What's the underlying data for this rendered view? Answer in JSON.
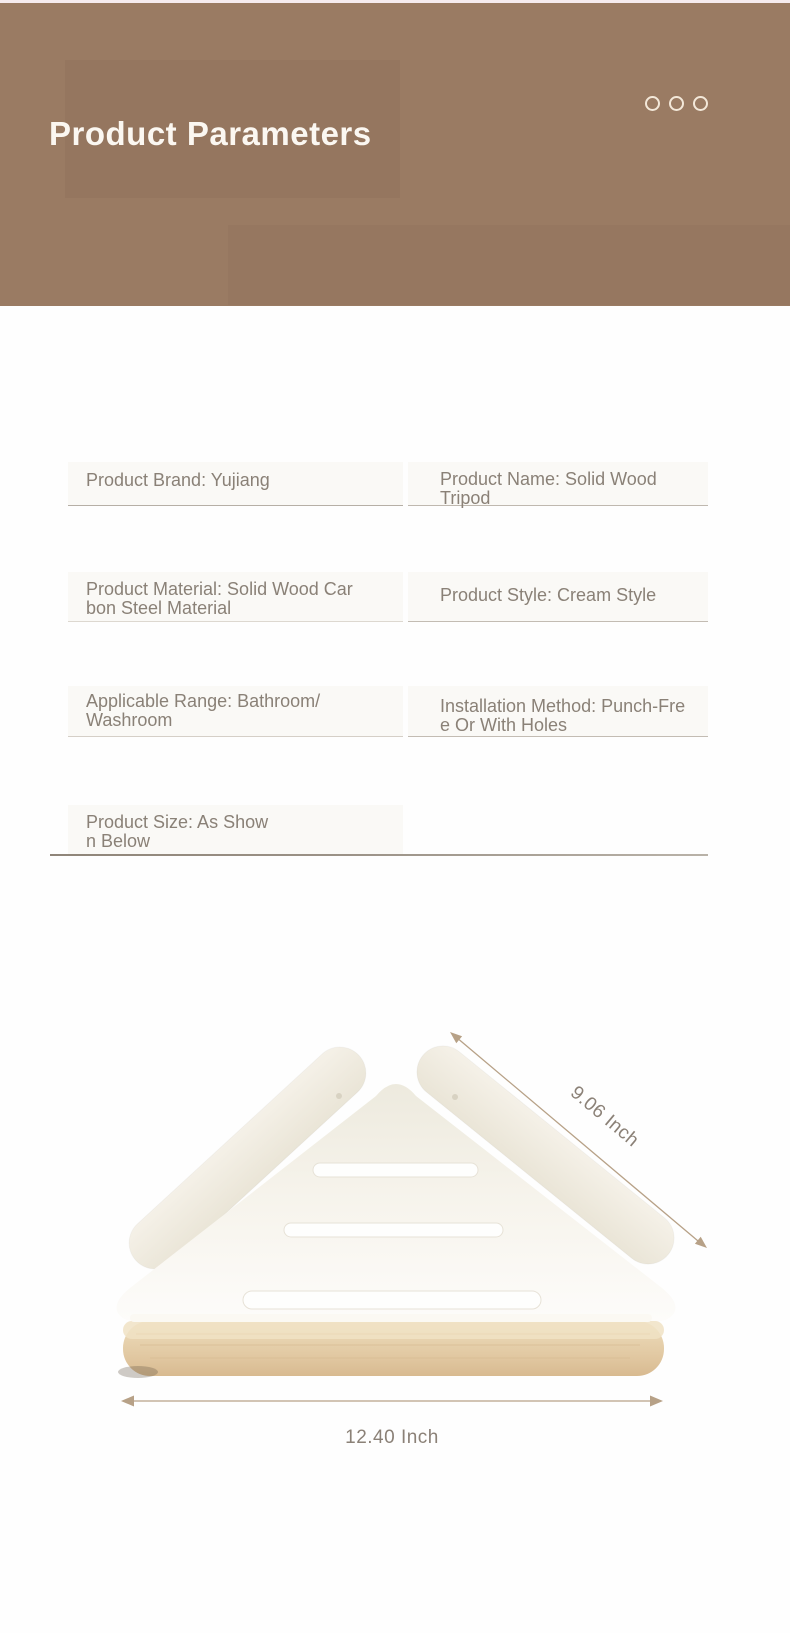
{
  "header": {
    "title": "Product Parameters",
    "bg_color": "#9a7b63",
    "title_color": "#fbf7f1",
    "dots": {
      "icon": "circle-outline-icon",
      "count": 3,
      "color": "#f3e8d9"
    }
  },
  "parameters": {
    "text_color": "#8a8177",
    "rows": [
      {
        "left": "Product Brand: Yujiang",
        "right": "Product Name: Solid Wood Tripod"
      },
      {
        "left": "Product Material: Solid Wood Car\nbon Steel Material",
        "right": "Product Style: Cream Style"
      },
      {
        "left": "Applicable Range: Bathroom/\nWashroom",
        "right": "Installation Method: Punch-Fre\ne Or With Holes"
      },
      {
        "left": "Product Size: As Show\nn Below",
        "right": ""
      }
    ]
  },
  "figure": {
    "diagonal_dimension": "9.06 Inch",
    "width_dimension": "12.40 Inch",
    "colors": {
      "shelf_white": "#f4f0e7",
      "wood_base": "#e2c8a2",
      "dimension_line": "#b7a187",
      "dimension_text": "#8b8177"
    }
  }
}
